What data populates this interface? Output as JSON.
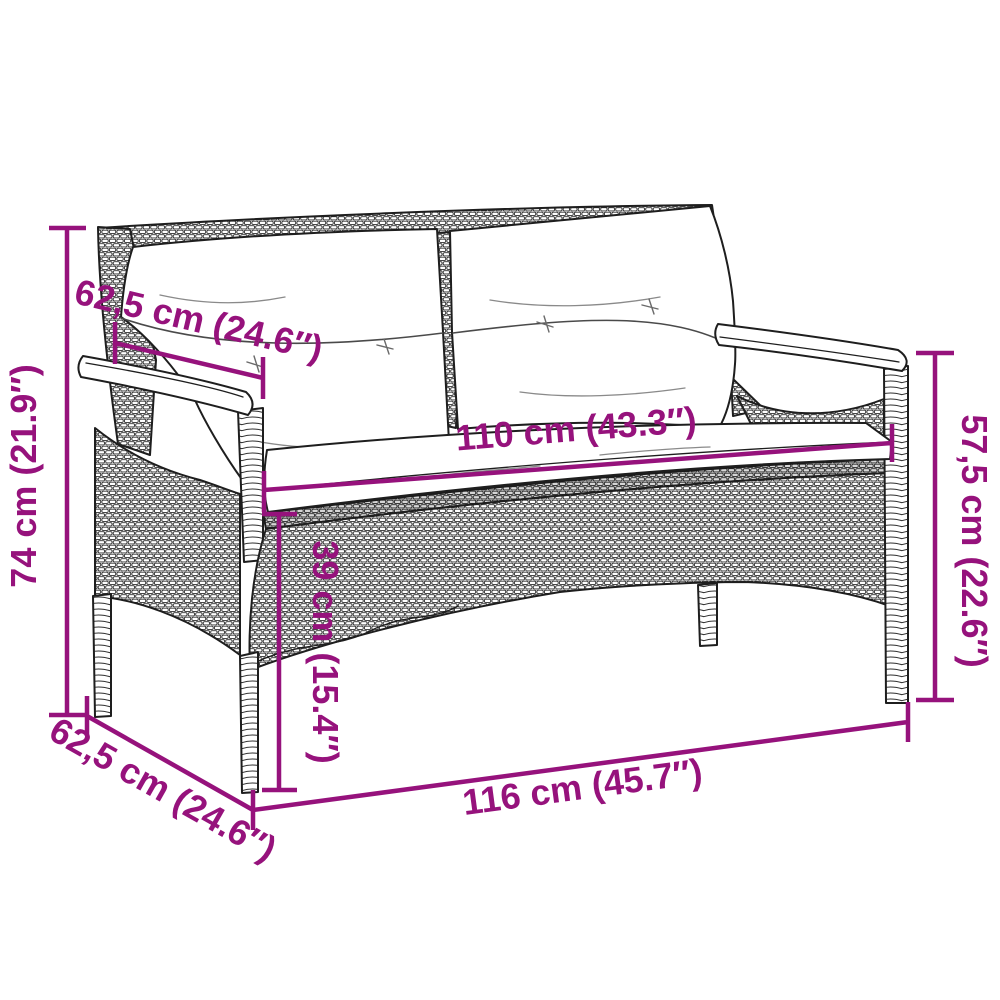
{
  "diagram": {
    "subject": "poly rattan garden bench with seat and back cushions",
    "accent_color": "#96127C",
    "outline_color": "#1e1e1e",
    "background_color": "#ffffff",
    "dimensions": {
      "overall_height": "74 cm (21.9″)",
      "depth_top": "62,5 cm (24.6″)",
      "seat_width": "110 cm (43.3″)",
      "seat_height": "39 cm (15.4″)",
      "backrest_height": "57,5 cm (22.6″)",
      "depth_bottom": "62,5 cm (24.6″)",
      "overall_width": "116 cm (45.7″)"
    }
  }
}
